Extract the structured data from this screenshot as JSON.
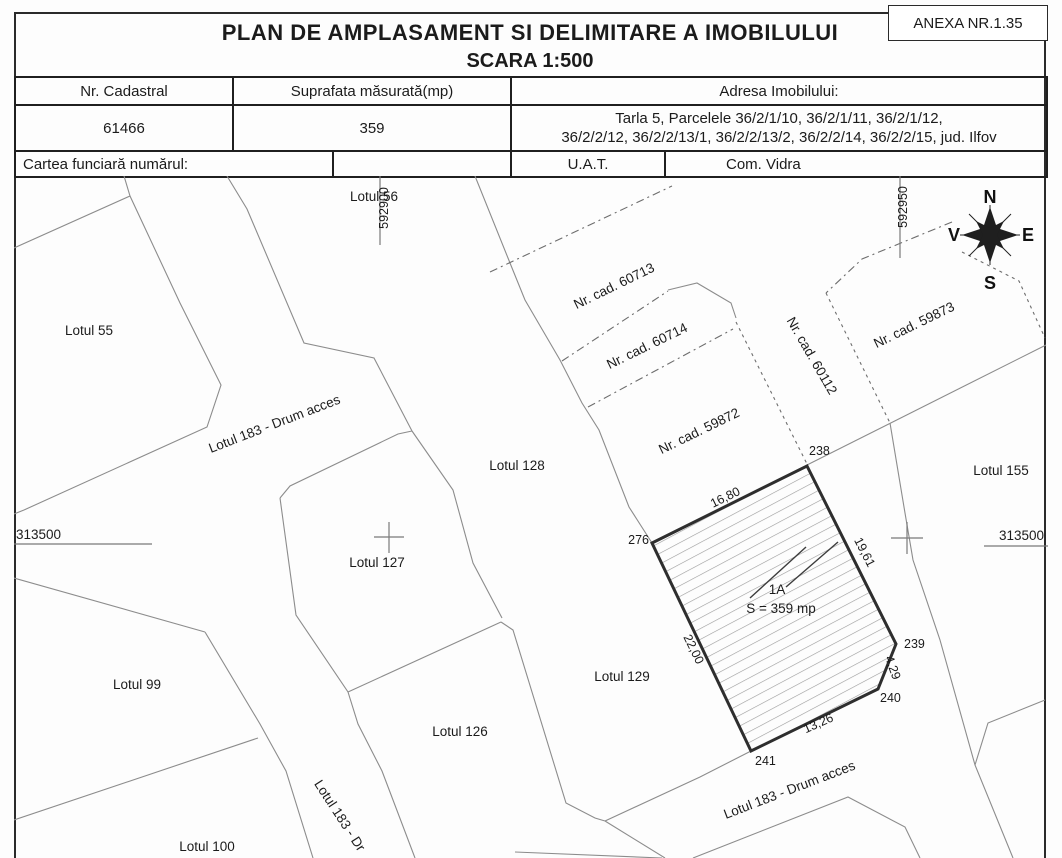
{
  "anexa": "ANEXA NR.1.35",
  "title": {
    "line1": "PLAN DE AMPLASAMENT SI DELIMITARE A IMOBILULUI",
    "line2": "SCARA 1:500"
  },
  "table": {
    "nr_cadastral": {
      "header": "Nr. Cadastral",
      "value": "61466"
    },
    "suprafata": {
      "header": "Suprafata măsurată(mp)",
      "value": "359"
    },
    "adresa": {
      "header": "Adresa Imobilului:",
      "value_line1": "Tarla 5, Parcelele 36/2/1/10, 36/2/1/11, 36/2/1/12,",
      "value_line2": "36/2/2/12, 36/2/2/13/1, 36/2/2/13/2, 36/2/2/14, 36/2/2/15, jud. Ilfov"
    },
    "cartea_funciara_label": "Cartea funciară numărul:",
    "uat_label": "U.A.T.",
    "uat_value": "Com. Vidra"
  },
  "map": {
    "grid": {
      "n_left": "592900",
      "n_right": "592950",
      "e_left": "313500",
      "e_right": "313500"
    },
    "compass": {
      "n": "N",
      "e": "E",
      "s": "S",
      "v": "V"
    },
    "lots": {
      "lotul55": "Lotul 55",
      "lotul56": "Lotul 56",
      "lotul99": "Lotul 99",
      "lotul100": "Lotul 100",
      "lotul126": "Lotul 126",
      "lotul127": "Lotul 127",
      "lotul128": "Lotul 128",
      "lotul129": "Lotul 129",
      "lotul155": "Lotul 155"
    },
    "cadastral": {
      "c60713": "Nr. cad. 60713",
      "c60714": "Nr. cad. 60714",
      "c59872": "Nr. cad. 59872",
      "c60112": "Nr. cad. 60112",
      "c59873": "Nr. cad. 59873"
    },
    "roads": {
      "upper": "Lotul 183 - Drum acces",
      "lower": "Lotul 183 - Drum acces",
      "vertical": "Lotul 183 - Dr"
    },
    "parcel": {
      "id": "1A",
      "area": "S = 359 mp",
      "v276": "276",
      "v238": "238",
      "v239": "239",
      "v240": "240",
      "v241": "241",
      "d_top": "16,80",
      "d_right": "19,61",
      "d_right2": "4,29",
      "d_bottom": "13,26",
      "d_left": "22,00"
    }
  }
}
